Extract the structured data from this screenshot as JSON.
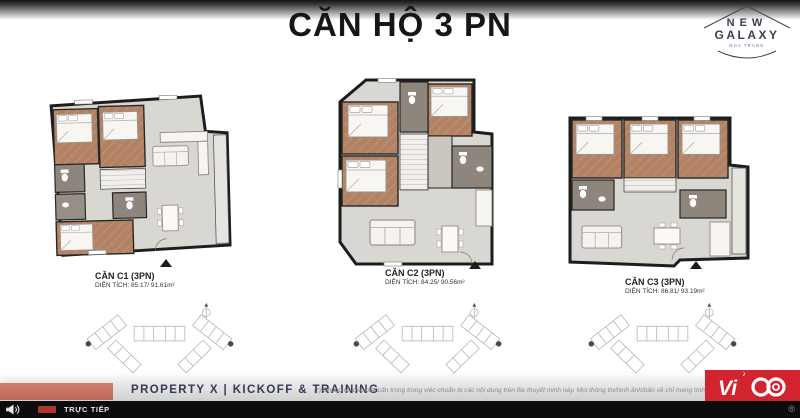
{
  "header": {
    "title": "CĂN HỘ 3 PN",
    "logo": {
      "line1": "NEW",
      "line2": "GALAXY",
      "tagline": "NHA TRANG"
    }
  },
  "units": [
    {
      "name": "CĂN C1 (3PN)",
      "area": "DIỆN TÍCH: 85.17/ 91.61m²"
    },
    {
      "name": "CĂN C2 (3PN)",
      "area": "DIỆN TÍCH: 84.25/ 90.56m²"
    },
    {
      "name": "CĂN C3 (3PN)",
      "area": "DIỆN TÍCH: 86.81/ 93.19m²"
    }
  ],
  "footer": {
    "event_title": "PROPERTY X | KICKOFF & TRAINING",
    "disclaimer": "(*) Chúng tôi đặc biệt cẩn trọng trong việc chuẩn bị các nội dung trên file thuyết minh này. Mọi thông tin/hình ảnh/bản vẽ chỉ mang tính",
    "brand_text": "Vi",
    "rights_glyph": "®"
  },
  "status_bar": {
    "live_label": "TRỰC TIẾP"
  },
  "colors": {
    "accent_red": "#bb6754",
    "vico_red": "#d2232e",
    "navy": "#333a56",
    "wood": "#b28264",
    "living_gray": "#d9d7d1",
    "bath_taupe": "#8e857c"
  }
}
